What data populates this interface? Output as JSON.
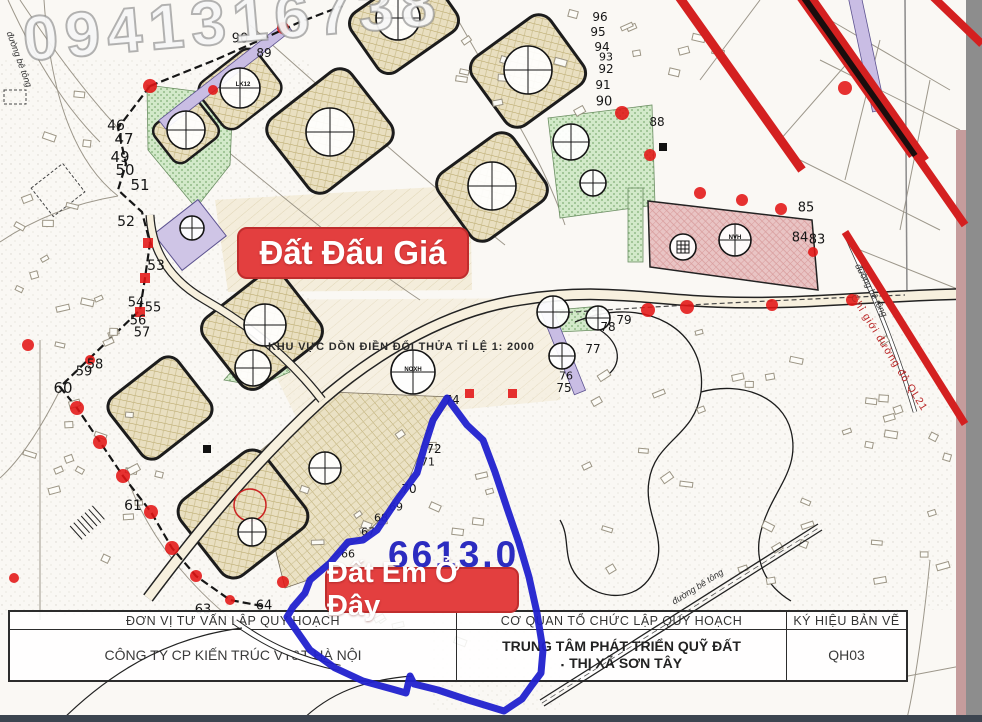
{
  "watermark": {
    "phone": "0941316738"
  },
  "badges": {
    "auction": "Đất Đấu Giá",
    "here": "Đất Em Ở Đây"
  },
  "plot": {
    "area_label": "6613.0"
  },
  "map": {
    "zone_note": "KHU VỰC DỒN ĐIỀN ĐỔI THỬA TỈ LỆ 1: 2000",
    "red_line_label": "Chỉ giới đường đỏ QL21",
    "road_labels": [
      {
        "text": "đường bê tông",
        "x": 670,
        "y": 598,
        "rotate": -32
      },
      {
        "text": "đường bê tông",
        "x": 862,
        "y": 262,
        "rotate": 62
      },
      {
        "text": "đường bê tông",
        "x": 14,
        "y": 30,
        "rotate": 70
      }
    ],
    "circle_labels": [
      {
        "text": "LK12",
        "x": 243,
        "y": 85
      },
      {
        "text": "NOXH",
        "x": 413,
        "y": 370
      },
      {
        "text": "NVH",
        "x": 735,
        "y": 238
      }
    ],
    "parcel_numbers": [
      {
        "t": "46",
        "x": 116,
        "y": 126,
        "s": 14
      },
      {
        "t": "47",
        "x": 124,
        "y": 139,
        "s": 15
      },
      {
        "t": "49",
        "x": 120,
        "y": 157,
        "s": 15
      },
      {
        "t": "50",
        "x": 125,
        "y": 170,
        "s": 15
      },
      {
        "t": "51",
        "x": 140,
        "y": 185,
        "s": 15
      },
      {
        "t": "52",
        "x": 126,
        "y": 222,
        "s": 14
      },
      {
        "t": "53",
        "x": 156,
        "y": 266,
        "s": 14
      },
      {
        "t": "54",
        "x": 136,
        "y": 303
      },
      {
        "t": "55",
        "x": 153,
        "y": 308
      },
      {
        "t": "56",
        "x": 138,
        "y": 321
      },
      {
        "t": "57",
        "x": 142,
        "y": 333
      },
      {
        "t": "58",
        "x": 95,
        "y": 365
      },
      {
        "t": "59",
        "x": 84,
        "y": 372
      },
      {
        "t": "60",
        "x": 63,
        "y": 388,
        "s": 15
      },
      {
        "t": "61",
        "x": 133,
        "y": 506,
        "s": 14
      },
      {
        "t": "63",
        "x": 203,
        "y": 610
      },
      {
        "t": "64",
        "x": 264,
        "y": 606
      },
      {
        "t": "66",
        "x": 348,
        "y": 554,
        "s": 11
      },
      {
        "t": "67",
        "x": 368,
        "y": 532,
        "s": 11
      },
      {
        "t": "68",
        "x": 381,
        "y": 518,
        "s": 11
      },
      {
        "t": "69",
        "x": 396,
        "y": 507,
        "s": 11
      },
      {
        "t": "70",
        "x": 409,
        "y": 489,
        "s": 12
      },
      {
        "t": "71",
        "x": 428,
        "y": 462,
        "s": 11
      },
      {
        "t": "72",
        "x": 434,
        "y": 449,
        "s": 12
      },
      {
        "t": "74",
        "x": 452,
        "y": 400,
        "s": 12
      },
      {
        "t": "75",
        "x": 564,
        "y": 388,
        "s": 12
      },
      {
        "t": "76",
        "x": 566,
        "y": 376,
        "s": 11
      },
      {
        "t": "77",
        "x": 593,
        "y": 349,
        "s": 12
      },
      {
        "t": "78",
        "x": 608,
        "y": 327,
        "s": 12
      },
      {
        "t": "79",
        "x": 624,
        "y": 320,
        "s": 12
      },
      {
        "t": "83",
        "x": 817,
        "y": 240
      },
      {
        "t": "84",
        "x": 800,
        "y": 238
      },
      {
        "t": "85",
        "x": 806,
        "y": 208
      },
      {
        "t": "88",
        "x": 657,
        "y": 122,
        "s": 12
      },
      {
        "t": "89",
        "x": 264,
        "y": 53,
        "s": 12
      },
      {
        "t": "90",
        "x": 240,
        "y": 39
      },
      {
        "t": "90",
        "x": 604,
        "y": 102
      },
      {
        "t": "91",
        "x": 603,
        "y": 85,
        "s": 12
      },
      {
        "t": "92",
        "x": 606,
        "y": 69,
        "s": 12
      },
      {
        "t": "93",
        "x": 606,
        "y": 57,
        "s": 11
      },
      {
        "t": "94",
        "x": 602,
        "y": 47,
        "s": 12
      },
      {
        "t": "95",
        "x": 598,
        "y": 32,
        "s": 12
      },
      {
        "t": "96",
        "x": 600,
        "y": 17,
        "s": 12
      }
    ]
  },
  "title_block": {
    "col1": {
      "header": "ĐƠN VỊ TƯ VẤN LẬP QUY HOẠCH",
      "body": "CÔNG TY CP KIẾN TRÚC VT&T HÀ NỘI"
    },
    "col2": {
      "header": "CƠ QUAN TỔ CHỨC LẬP QUY HOẠCH",
      "body_line1": "TRUNG TÂM PHÁT TRIỂN QUỸ ĐẤT",
      "bullet": "▪",
      "body_line2": "THỊ XÃ SƠN TÂY"
    },
    "col3": {
      "header": "KÝ HIỆU BẢN VẼ",
      "body": "QH03"
    }
  },
  "colors": {
    "annotation_red": "#e33f3f",
    "plot_outline_blue": "#2121cd",
    "red_line": "#d42020",
    "map_tan": "#e9dfc0",
    "map_green": "#d2e9c9",
    "map_pink": "#e9c4c4",
    "map_purple": "#cfc5e6"
  }
}
